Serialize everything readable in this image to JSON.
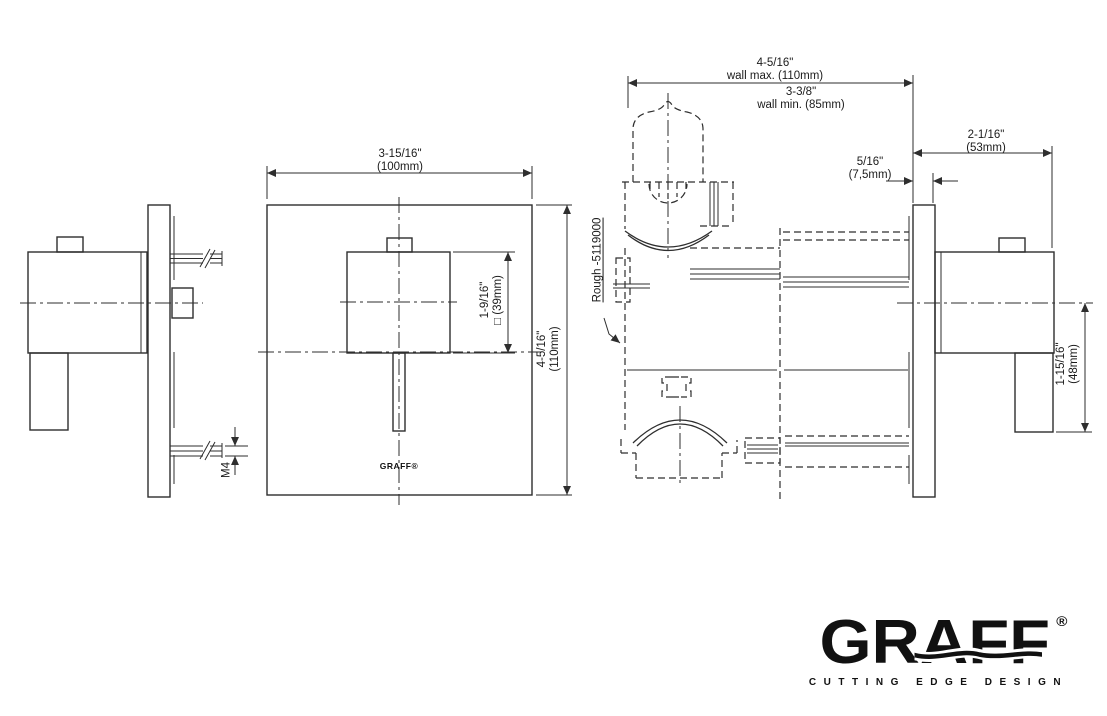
{
  "labels": {
    "wall_max_value": "4-5/16\"",
    "wall_max_note": "wall max. (110mm)",
    "wall_min_value": "3-3/8\"",
    "wall_min_note": "wall min. (85mm)",
    "plate_thickness_value": "5/16\"",
    "plate_thickness_mm": "(7,5mm)",
    "protrusion_value": "2-1/16\"",
    "protrusion_mm": "(53mm)",
    "plate_width_value": "3-15/16\"",
    "plate_width_mm": "(100mm)",
    "handle_size_value": "1-9/16\"",
    "handle_size_mm": "□ (39mm)",
    "plate_height_value": "4-5/16\"",
    "plate_height_mm": "(110mm)",
    "lever_drop_value": "1-15/16\"",
    "lever_drop_mm": "(48mm)",
    "rough_in_code": "Rough -5119000",
    "screw_thread": "M4"
  },
  "branding": {
    "plate_logo": "GRAFF®",
    "logo_text": "GRAFF",
    "logo_registered": "®",
    "tagline": "CUTTING EDGE DESIGN"
  },
  "colors": {
    "line": "#2e2e2e",
    "text": "#1b1b1b",
    "background": "#ffffff"
  }
}
